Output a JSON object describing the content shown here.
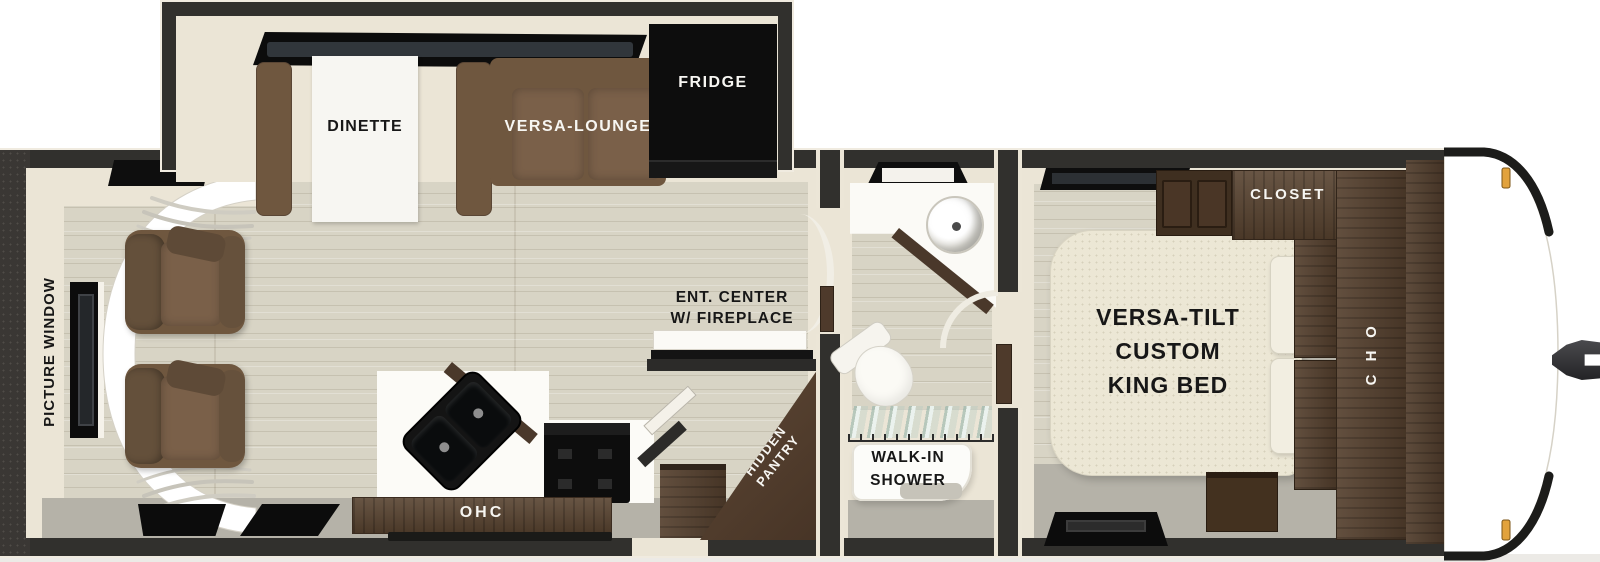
{
  "title": "Travel trailer floorplan",
  "colors": {
    "wall": "#31302d",
    "trim_cream": "#ebe5d6",
    "floor_wood": "#d8d4c5",
    "floor_gray": "#b5b2a8",
    "cabinet_walnut": "#55402e",
    "upholstery_brown": "#6f573f",
    "bed_cream": "#ece7d5",
    "appliance_black": "#0d0d0d",
    "marker_light_amber": "#e2a23c"
  },
  "slideout": {
    "dinette": "DINETTE",
    "versa_lounge": "VERSA-LOUNGE",
    "fridge": "FRIDGE"
  },
  "living": {
    "picture_window": "PICTURE WINDOW",
    "ent_center_line1": "ENT. CENTER",
    "ent_center_line2": "W/ FIREPLACE",
    "ohc": "OHC",
    "pantry_line1": "HIDDEN",
    "pantry_line2": "PANTRY"
  },
  "bath": {
    "shower_line1": "WALK-IN",
    "shower_line2": "SHOWER"
  },
  "bedroom": {
    "bed_line1": "VERSA-TILT",
    "bed_line2": "CUSTOM",
    "bed_line3": "KING BED",
    "closet": "CLOSET",
    "ohc": "OHC"
  }
}
